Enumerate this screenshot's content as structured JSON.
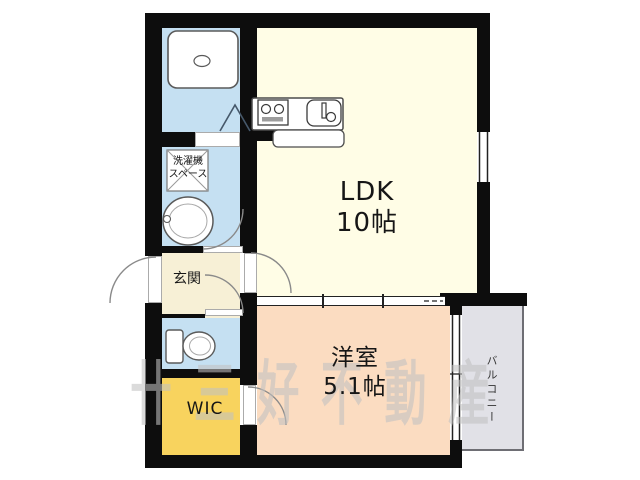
{
  "plan": {
    "title": "apartment-floor-plan",
    "rooms": {
      "ldk": {
        "name": "LDK",
        "size": "10帖"
      },
      "bedroom": {
        "name": "洋室",
        "size": "5.1帖"
      },
      "entrance": {
        "label": "玄関"
      },
      "wic": {
        "label": "WIC"
      },
      "balcony": {
        "label": "バルコニー"
      },
      "laundry_space": {
        "line1": "洗濯機",
        "line2": "スペース"
      }
    },
    "watermark": {
      "logo_mark": "卄",
      "text": "三好不動産"
    },
    "colors": {
      "wall": "#0d0d0d",
      "ldk": "#fffde6",
      "bedroom": "#fbdcc1",
      "wet_rooms": "#c5e0f2",
      "entrance_hall": "#f7f0d6",
      "wic": "#f8d35e",
      "balcony": "#e1e1e7",
      "watermark": "#c1c1c1"
    }
  }
}
